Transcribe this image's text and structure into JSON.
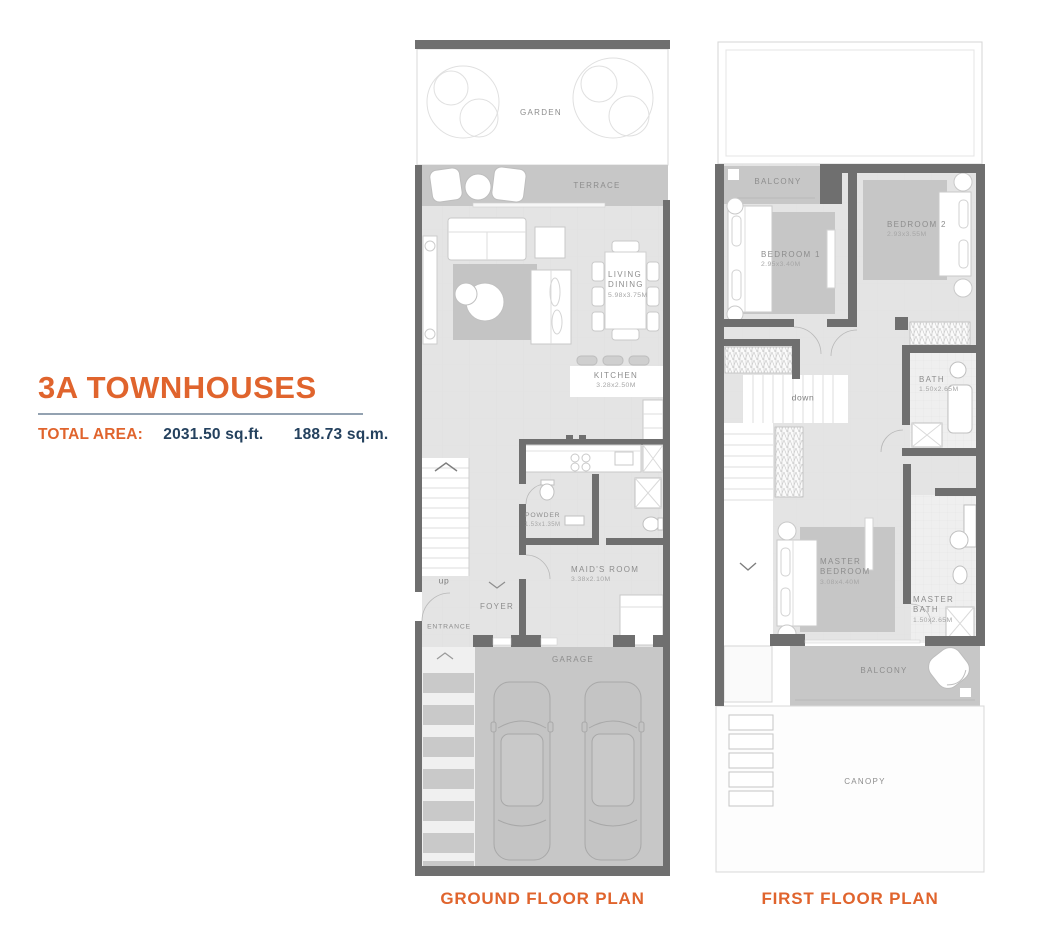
{
  "header": {
    "title": "3A TOWNHOUSES",
    "total_area_label": "TOTAL AREA:",
    "area_sqft": "2031.50 sq.ft.",
    "area_sqm": "188.73 sq.m."
  },
  "colors": {
    "accent_orange": "#E0642D",
    "navy": "#24415E",
    "wall_gray": "#6F6F6F",
    "floor_light": "#E4E4E4",
    "paving_gray": "#C7C7C7"
  },
  "ground_floor": {
    "caption": "GROUND FLOOR PLAN",
    "labels": {
      "garden": "GARDEN",
      "terrace": "TERRACE",
      "living_dining": "LIVING DINING",
      "living_dining_dims": "5.98x3.75M",
      "kitchen": "KITCHEN",
      "kitchen_dims": "3.28x2.50M",
      "powder": "POWDER",
      "powder_dims": "1.53x1.35M",
      "maids_room": "MAID'S ROOM",
      "maids_room_dims": "3.38x2.10M",
      "up": "up",
      "foyer": "FOYER",
      "entrance": "ENTRANCE",
      "garage": "GARAGE"
    }
  },
  "first_floor": {
    "caption": "FIRST FLOOR PLAN",
    "labels": {
      "balcony_front": "BALCONY",
      "bedroom1": "BEDROOM 1",
      "bedroom1_dims": "2.95x3.40M",
      "bedroom2": "BEDROOM 2",
      "bedroom2_dims": "2.93x3.55M",
      "down": "down",
      "bath": "BATH",
      "bath_dims": "1.50x2.65M",
      "master_bedroom": "MASTER BEDROOM",
      "master_bedroom_dims": "3.08x4.40M",
      "master_bath": "MASTER BATH",
      "master_bath_dims": "1.50x2.65M",
      "balcony_rear": "BALCONY",
      "canopy": "CANOPY"
    }
  }
}
